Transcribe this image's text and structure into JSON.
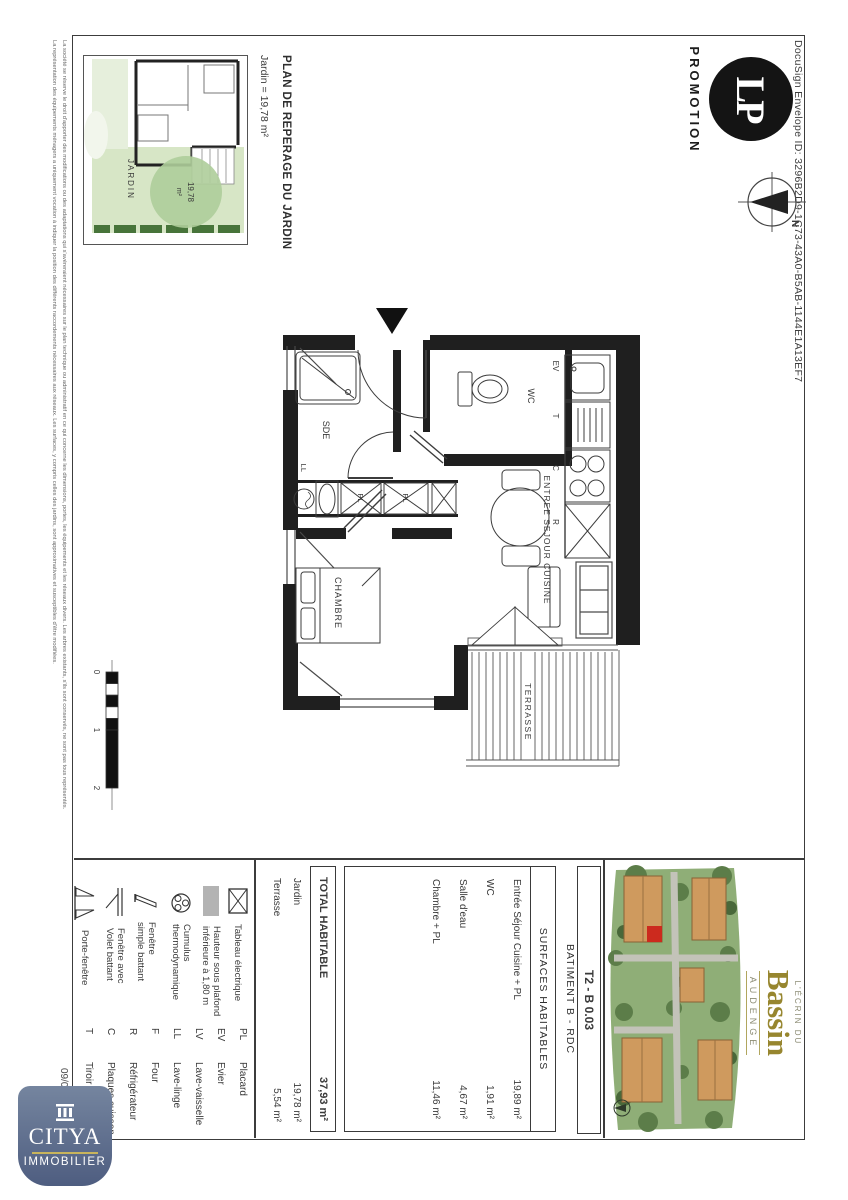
{
  "doc": {
    "docusign_line": "DocuSign Envelope ID: 3296B2D9-1C73-43A0-B5AB-1144E1A13EF7",
    "date": "09/01/2023",
    "disclaimer_line1": "La société se réserve le droit d'apporter des modifications ou des adaptations qui s'avéreraient nécessaires sur le plan technique ou administratif en ce qui concerne les dimensions, portes, les équipements et les réseaux divers. Les arbres existants, s'ils sont conservés, ne sont pas tous représentés.",
    "disclaimer_line2": "La représentation des équipements ménagers a uniquement vocation à indiquer la position des différents raccordements nécessaires aux réseaux. Les surfaces, y compris celles des jardins, sont approximatives et susceptibles d'être modifiées."
  },
  "header": {
    "lp_monogram": "LP",
    "lp_label": "PROMOTION",
    "compass_north": "N"
  },
  "reperage": {
    "title": "PLAN DE REPERAGE DU JARDIN",
    "subtitle": "Jardin = 19,78 m²",
    "jardin_label": "JARDIN",
    "circle_value": "19,78",
    "circle_unit": "m²"
  },
  "plan": {
    "rooms": {
      "sde": "SDE",
      "wc": "WC",
      "sejour": "ENTREE SEJOUR CUISINE",
      "chambre": "CHAMBRE",
      "terrasse": "TERRASSE"
    },
    "labels": {
      "ev": "EV",
      "t": "T",
      "c": "C",
      "r": "R",
      "pl": "PL",
      "ll": "LL"
    }
  },
  "scalebar": {
    "t0": "0",
    "t1": "1",
    "t2": "2"
  },
  "titleblock": {
    "lot": "T2 - B 0.03",
    "batiment": "BATIMENT B  -  RDC",
    "surfaces_header": "SURFACES HABITABLES",
    "rows": [
      {
        "label": "Entrée Séjour Cuisine + PL",
        "value": "19,89  m²"
      },
      {
        "label": "WC",
        "value": "1,91  m²"
      },
      {
        "label": "Salle d'eau",
        "value": "4,67  m²"
      },
      {
        "label": "Chambre + PL",
        "value": "11,46  m²"
      }
    ],
    "total": {
      "label": "TOTAL HABITABLE",
      "value": "37,93 m²"
    },
    "annexes": [
      {
        "label": "Jardin",
        "value": "19,78  m²"
      },
      {
        "label": "Terrasse",
        "value": "5,54  m²"
      }
    ]
  },
  "legend": {
    "items": [
      {
        "icon": "tableau-electrique-icon",
        "label": "Tableau électrique"
      },
      {
        "icon": "hauteur-plafond-icon",
        "label": "Hauteur sous plafond\ninférieure à 1,80 m"
      },
      {
        "icon": "cumulus-icon",
        "label": "Cumulus\nthermodynamique"
      },
      {
        "icon": "fenetre-simple-icon",
        "label": "Fenêtre\nsimple battant"
      },
      {
        "icon": "fenetre-volet-icon",
        "label": "Fenêtre avec\nVolet battant"
      },
      {
        "icon": "porte-fenetre-icon",
        "label": "Porte-fenêtre"
      }
    ],
    "abbreviations": [
      {
        "abbr": "PL",
        "label": "Placard"
      },
      {
        "abbr": "EV",
        "label": "Evier"
      },
      {
        "abbr": "LV",
        "label": "Lave-vaisselle"
      },
      {
        "abbr": "LL",
        "label": "Lave-linge"
      },
      {
        "abbr": "F",
        "label": "Four"
      },
      {
        "abbr": "R",
        "label": "Réfrigérateur"
      },
      {
        "abbr": "C",
        "label": "Plaques cuisson"
      },
      {
        "abbr": "T",
        "label": "Tiroir"
      }
    ]
  },
  "ecrin": {
    "prefix": "L'ÉCRIN DU",
    "name": "Bassin",
    "city": "AUDENGE"
  },
  "citya": {
    "name": "CITYA",
    "sub": "IMMOBILIER"
  },
  "colors": {
    "wall": "#1f1f1f",
    "garden": "#d7e6c6",
    "gold": "#97862f",
    "citya_blue": "#5a6a8e",
    "highlight_red": "#cc2a1e"
  }
}
